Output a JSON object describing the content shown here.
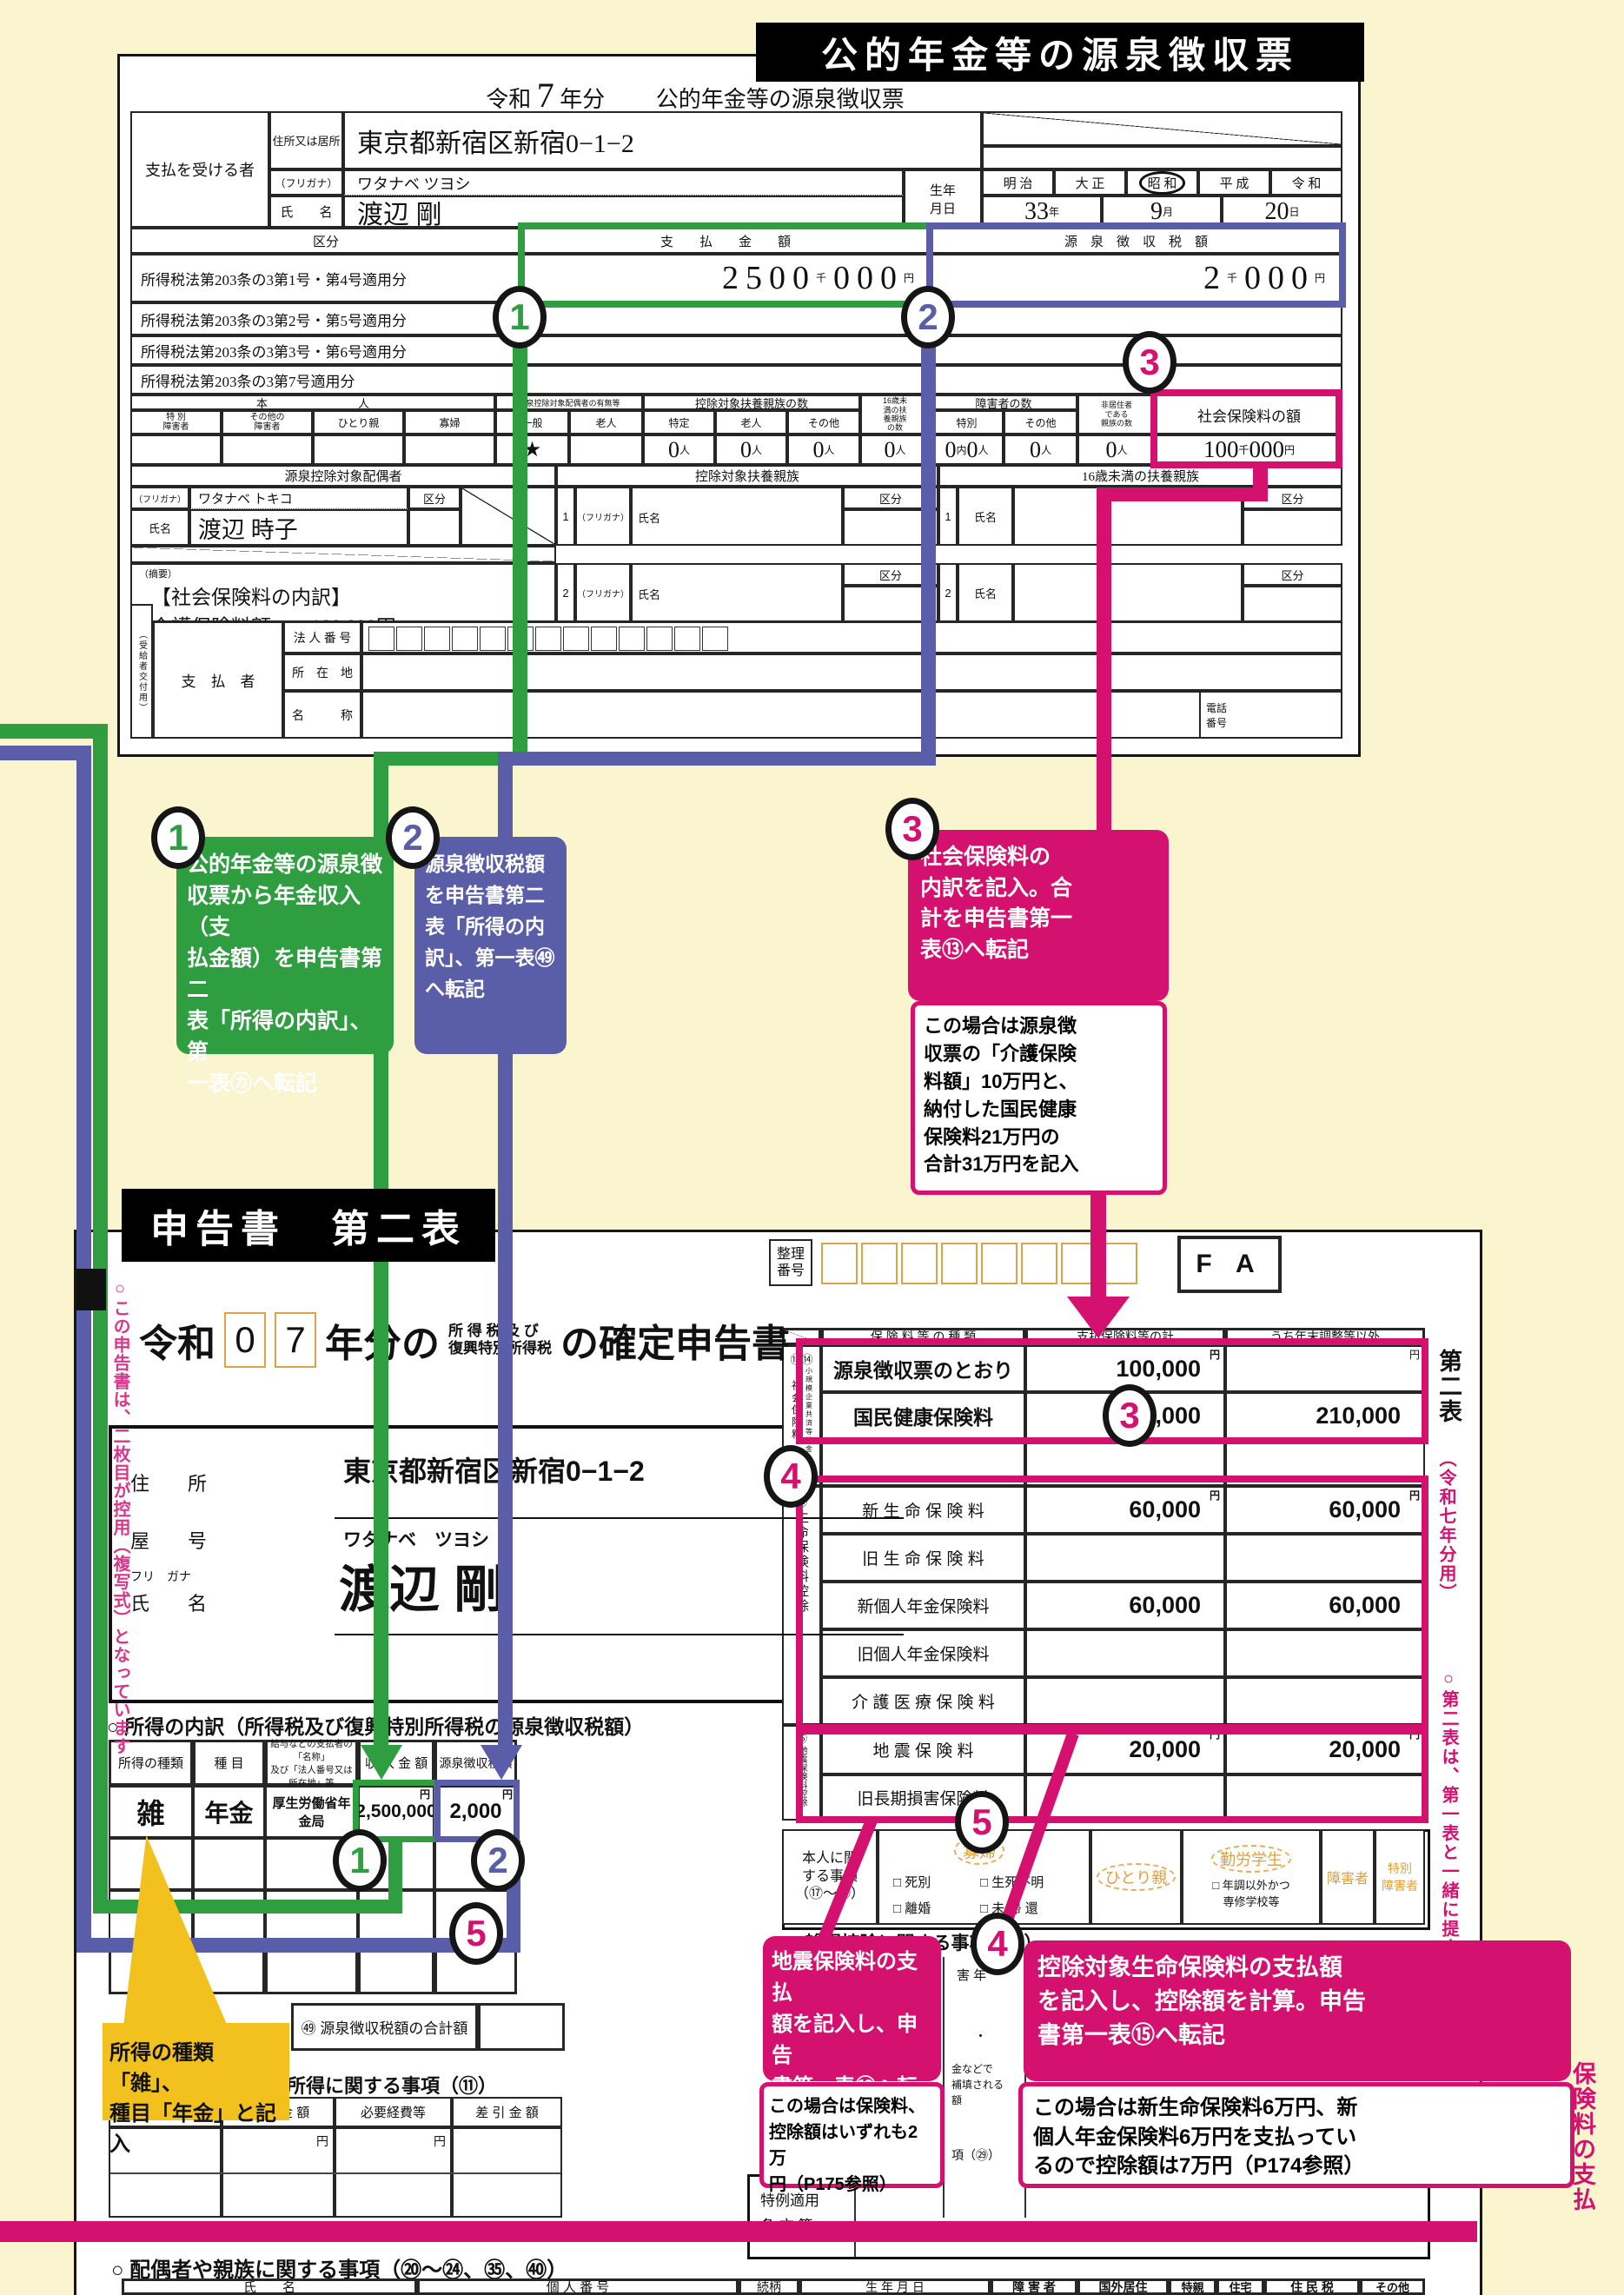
{
  "colors": {
    "background": "#faf4cf",
    "green": "#2e9e41",
    "purple": "#5a5da8",
    "pink": "#d4116f",
    "yellow": "#f2c11e",
    "orange": "#dfa245",
    "black": "#000000"
  },
  "banner_top": "公的年金等の源泉徴収票",
  "markers": {
    "m1": "1",
    "m2": "2",
    "m3": "3",
    "m4": "4",
    "m5": "5"
  },
  "gensen": {
    "title": {
      "era": "令和",
      "year": "7",
      "suffix": "年分",
      "name": "公的年金等の源泉徴収票"
    },
    "payee_label": "支払を受ける者",
    "addr_label": "住所又は居所",
    "addr": "東京都新宿区新宿0−1−2",
    "kana_label": "（フリガナ）",
    "kana": "ワタナベ ツヨシ",
    "name_label": "氏　　名",
    "name": "渡辺 剛",
    "birth_label": "生年\n月日",
    "eras": [
      "明 治",
      "大 正",
      "昭 和",
      "平 成",
      "令 和"
    ],
    "birth": {
      "year": "33",
      "y": "年",
      "month": "9",
      "m": "月",
      "day": "20",
      "d": "日"
    },
    "kubun": "区分",
    "pay_col": "支　　払　　金　　額",
    "tax_col": "源　泉　徴　収　税　額",
    "law_rows": [
      "所得税法第203条の3第1号・第4号適用分",
      "所得税法第203条の3第2号・第5号適用分",
      "所得税法第203条の3第3号・第6号適用分",
      "所得税法第203条の3第7号適用分"
    ],
    "pay_val": {
      "a": "2",
      "b": "500",
      "c": "000"
    },
    "tax_val": {
      "a": "2",
      "b": "000"
    },
    "sen": "千",
    "yen": "円",
    "nin": "人",
    "uchi": "内",
    "zero": "0",
    "person": {
      "honnin": "本　　　　　　　　人",
      "c1": "特 別\n障害者",
      "c2": "その他の\n障害者",
      "c3": "ひとり親",
      "c4": "寡婦",
      "spouse": "源泉控除対象配偶者の有無等",
      "sp1": "一般",
      "sp2": "老人",
      "fuyou": "控除対象扶養親族の数",
      "f1": "特定",
      "f2": "老人",
      "f3": "その他",
      "u16": "16歳未\n満の扶\n養親族\nの数",
      "shogai": "障害者の数",
      "sh1": "特別",
      "sh2": "その他",
      "hikyoju": "非居住者\nである\n親族の数",
      "shaho": "社会保険料の額",
      "star": "★",
      "shaho_a": "100",
      "shaho_b": "000"
    },
    "spouse_sec": {
      "header": "源泉控除対象配偶者",
      "kana": "ワタナベ トキコ",
      "name": "渡辺 時子"
    },
    "fuyou_sec": {
      "header": "控除対象扶養親族",
      "u16": "16歳未満の扶養親族",
      "kana_label": "（フリガナ）",
      "name_label": "氏名",
      "kubun": "区分",
      "n1": "1",
      "n2": "2"
    },
    "tekiyo": {
      "label": "（摘要）",
      "l1": "【社会保険料の内訳】",
      "l2": "介護保険料額　　100,000円"
    },
    "payer": {
      "side": "（受給者交付用）",
      "label": "支　払　者",
      "r1": "法 人 番 号",
      "r2": "所　在　地",
      "r3": "名　　　称",
      "tel": "電話\n番号"
    }
  },
  "callouts": {
    "c1": {
      "text": "公的年金等の源泉徴\n収票から年金収入（支\n払金額）を申告書第二\n表「所得の内訳」、第\n一表㋕へ転記"
    },
    "c2": {
      "text": "源泉徴収税額\nを申告書第二\n表「所得の内\n訳」、第一表㊾\nへ転記"
    },
    "c3": {
      "text": "社会保険料の\n内訳を記入。合\n計を申告書第一\n表⑬へ転記",
      "note": "この場合は源泉徴\n収票の「介護保険\n料額」10万円と、\n納付した国民健康\n保険料21万円の\n合計31万円を記入"
    },
    "c4": {
      "text": "控除対象生命保険料の支払額\nを記入し、控除額を計算。申告\n書第一表⑮へ転記",
      "note": "この場合は新生命保険料6万円、新\n個人年金保険料6万円を支払ってい\nるので控除額は7万円（P174参照）"
    },
    "c5": {
      "text": "地震保険料の支払\n額を記入し、申告\n書第一表⑯へ転記",
      "note": "この場合は保険料、\n控除額はいずれも2万\n円（P175参照）"
    },
    "yellow": {
      "text": "所得の種類「雑」、\n種目「年金」と記入"
    }
  },
  "shinkoku": {
    "banner": "申告書　第二表",
    "title": {
      "era": "令和",
      "d1": "0",
      "d2": "7",
      "mid": "年分の",
      "small1": "所 得 税 及 び",
      "small2": "復興特別所得税",
      "tail": "の確定申告書"
    },
    "seiri": "整理\n番号",
    "fa": "F A",
    "labels": {
      "a": "住　　所",
      "b": "屋　　号",
      "c": "フリ　ガナ",
      "d": "氏　　名"
    },
    "addr": "東京都新宿区新宿0−1−2",
    "kana": "ワタナベ　ツヨシ",
    "name": "渡辺 剛",
    "uchiwake": {
      "heading": "○ 所得の内訳（所得税及び復興特別所得税の源泉徴収税額）",
      "c1": "所得の種類",
      "c2": "種 目",
      "c3": "給与などの支払者の「名称」\n及び「法人番号又は所在地」等",
      "c4": "収 入 金 額",
      "c5": "源泉徴収税額",
      "type": "雑",
      "item": "年金",
      "payer": "厚生労働省年金局",
      "income": "2,500,000",
      "tax": "2,000",
      "yen": "円"
    },
    "box49": "㊾ 源泉徴収税額の合計額",
    "sec11": {
      "heading": "所得に関する事項（⑪）",
      "c1": "所得の種類",
      "c2": "収 入 金 額",
      "c3": "必要経費等",
      "c4": "差 引 金 額",
      "yen": "円"
    },
    "ins": {
      "c1": "保 険 料 等 の 種 類",
      "c2": "支払保険料等の計",
      "c3": "うち年末調整等以外",
      "g1n": "⑬⑭",
      "g1a": "社会保険料",
      "g1b": "小規模企業共済等掛金",
      "g2n": "⑮",
      "g2": "生命保険料控除",
      "g3n": "⑯",
      "g3": "地震保険料控除",
      "yen": "円",
      "rows": [
        {
          "label": "源泉徴収票のとおり",
          "v1": "100,000",
          "v2": ""
        },
        {
          "label": "国民健康保険料",
          "v1": "210,000",
          "v2": "210,000"
        },
        {
          "label": "",
          "v1": "",
          "v2": ""
        },
        {
          "label": "新 生 命 保 険 料",
          "v1": "60,000",
          "v2": "60,000"
        },
        {
          "label": "旧 生 命 保 険 料",
          "v1": "",
          "v2": ""
        },
        {
          "label": "新個人年金保険料",
          "v1": "60,000",
          "v2": "60,000"
        },
        {
          "label": "旧個人年金保険料",
          "v1": "",
          "v2": ""
        },
        {
          "label": "介 護 医 療 保 険 料",
          "v1": "",
          "v2": ""
        },
        {
          "label": "地 震 保 険 料",
          "v1": "20,000",
          "v2": "20,000"
        },
        {
          "label": "旧長期損害保険料",
          "v1": "",
          "v2": ""
        }
      ]
    },
    "honnin": {
      "label": "本人に関\nする事項\n（⑰〜⑳）",
      "kafu": "寡婦",
      "k1": "□ 死別",
      "k2": "□ 生死不明",
      "k3": "□ 離婚",
      "k4": "□ 未 帰 還",
      "hitori": "ひとり親",
      "kinro": "勤労学生",
      "kc": "□ 年調以外かつ\n専修学校等",
      "sho": "障害者",
      "tokusho": "特別\n障害者"
    },
    "zasson": "○ 雑損控除に関する事項（㉗）",
    "sliver": {
      "a": "害 年",
      "b": "・",
      "c": "金などで\n補填される\n額",
      "d": "項（㉙）"
    },
    "tokurei": "特例適用\n条 文 等",
    "family": {
      "heading": "○ 配偶者や親族に関する事項（⑳〜㉔、㉟、㊵）",
      "c1": "氏　　名",
      "c2": "個 人 番 号",
      "c3": "続柄",
      "c4": "生 年 月 日",
      "c5": "障 害 者",
      "c6": "国外居住",
      "c7": "特親",
      "c8": "住宅",
      "c9": "住 民 税",
      "c10": "その他"
    },
    "side1a": "第二表",
    "side1b": "（令和七年分用）",
    "side2": "○第二表は、第一表と一緒に提出してください",
    "left_note": "○この申告書は、二枚目が控用（複写式）となっています",
    "right_frag": "保険料の支払"
  }
}
